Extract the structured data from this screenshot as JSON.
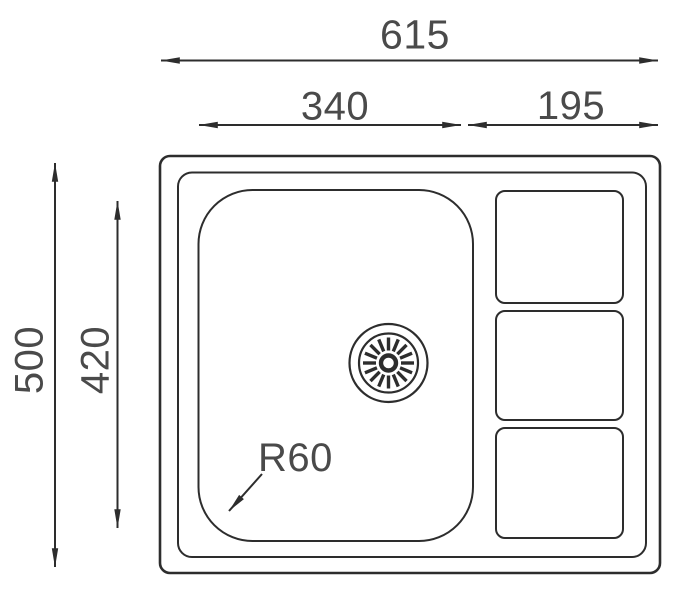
{
  "drawing": {
    "dimensions": {
      "overall_width": "615",
      "bowl_width": "340",
      "drainer_width": "195",
      "overall_depth": "500",
      "bowl_depth": "420",
      "bowl_corner_radius": "R60"
    },
    "colors": {
      "line": "#2d2d2d",
      "text": "#4a4a4a",
      "background": "#ffffff"
    }
  }
}
